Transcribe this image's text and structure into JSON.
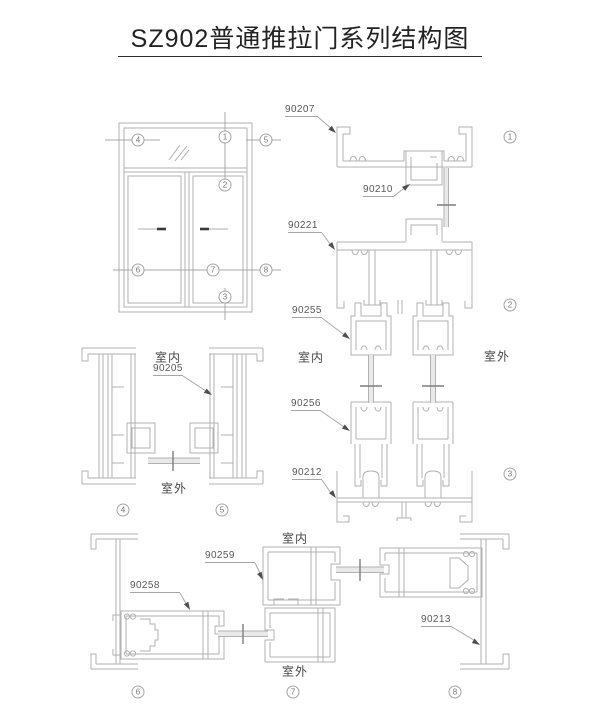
{
  "title": "SZ902普通推拉门系列结构图",
  "colors": {
    "line": "#b2b2b2",
    "text": "#595959",
    "title": "#232323",
    "arrow": "#4f4f4f"
  },
  "elevation": {
    "callouts": [
      {
        "n": "4",
        "x": 138,
        "y": 140
      },
      {
        "n": "1",
        "x": 225,
        "y": 137
      },
      {
        "n": "5",
        "x": 266,
        "y": 140
      },
      {
        "n": "2",
        "x": 225,
        "y": 185
      },
      {
        "n": "6",
        "x": 138,
        "y": 270
      },
      {
        "n": "7",
        "x": 213,
        "y": 270
      },
      {
        "n": "8",
        "x": 266,
        "y": 270
      },
      {
        "n": "3",
        "x": 225,
        "y": 297
      }
    ]
  },
  "sections": {
    "part_labels": [
      {
        "id": "90207",
        "x": 285,
        "y": 104,
        "w": 33
      },
      {
        "id": "90210",
        "x": 363,
        "y": 184,
        "w": 30
      },
      {
        "id": "90221",
        "x": 288,
        "y": 220,
        "w": 34
      },
      {
        "id": "90255",
        "x": 292,
        "y": 305,
        "w": 30
      },
      {
        "id": "90256",
        "x": 291,
        "y": 398,
        "w": 30
      },
      {
        "id": "90212",
        "x": 292,
        "y": 467,
        "w": 30
      },
      {
        "id": "90205",
        "x": 153,
        "y": 363,
        "w": 30
      },
      {
        "id": "90258",
        "x": 130,
        "y": 580,
        "w": 50
      },
      {
        "id": "90259",
        "x": 205,
        "y": 550,
        "w": 50
      },
      {
        "id": "90213",
        "x": 421,
        "y": 614,
        "w": 31
      }
    ],
    "room_labels": [
      {
        "text": "室内",
        "x": 311,
        "y": 357
      },
      {
        "text": "室外",
        "x": 497,
        "y": 356
      },
      {
        "text": "室内",
        "x": 168,
        "y": 357
      },
      {
        "text": "室外",
        "x": 174,
        "y": 488
      },
      {
        "text": "室内",
        "x": 295,
        "y": 538
      },
      {
        "text": "室外",
        "x": 295,
        "y": 671
      }
    ],
    "markers": [
      {
        "n": "1",
        "x": 510,
        "y": 137
      },
      {
        "n": "2",
        "x": 510,
        "y": 305
      },
      {
        "n": "3",
        "x": 510,
        "y": 474
      },
      {
        "n": "4",
        "x": 123,
        "y": 510
      },
      {
        "n": "5",
        "x": 222,
        "y": 510
      },
      {
        "n": "6",
        "x": 138,
        "y": 692
      },
      {
        "n": "7",
        "x": 293,
        "y": 692
      },
      {
        "n": "8",
        "x": 455,
        "y": 692
      }
    ]
  }
}
